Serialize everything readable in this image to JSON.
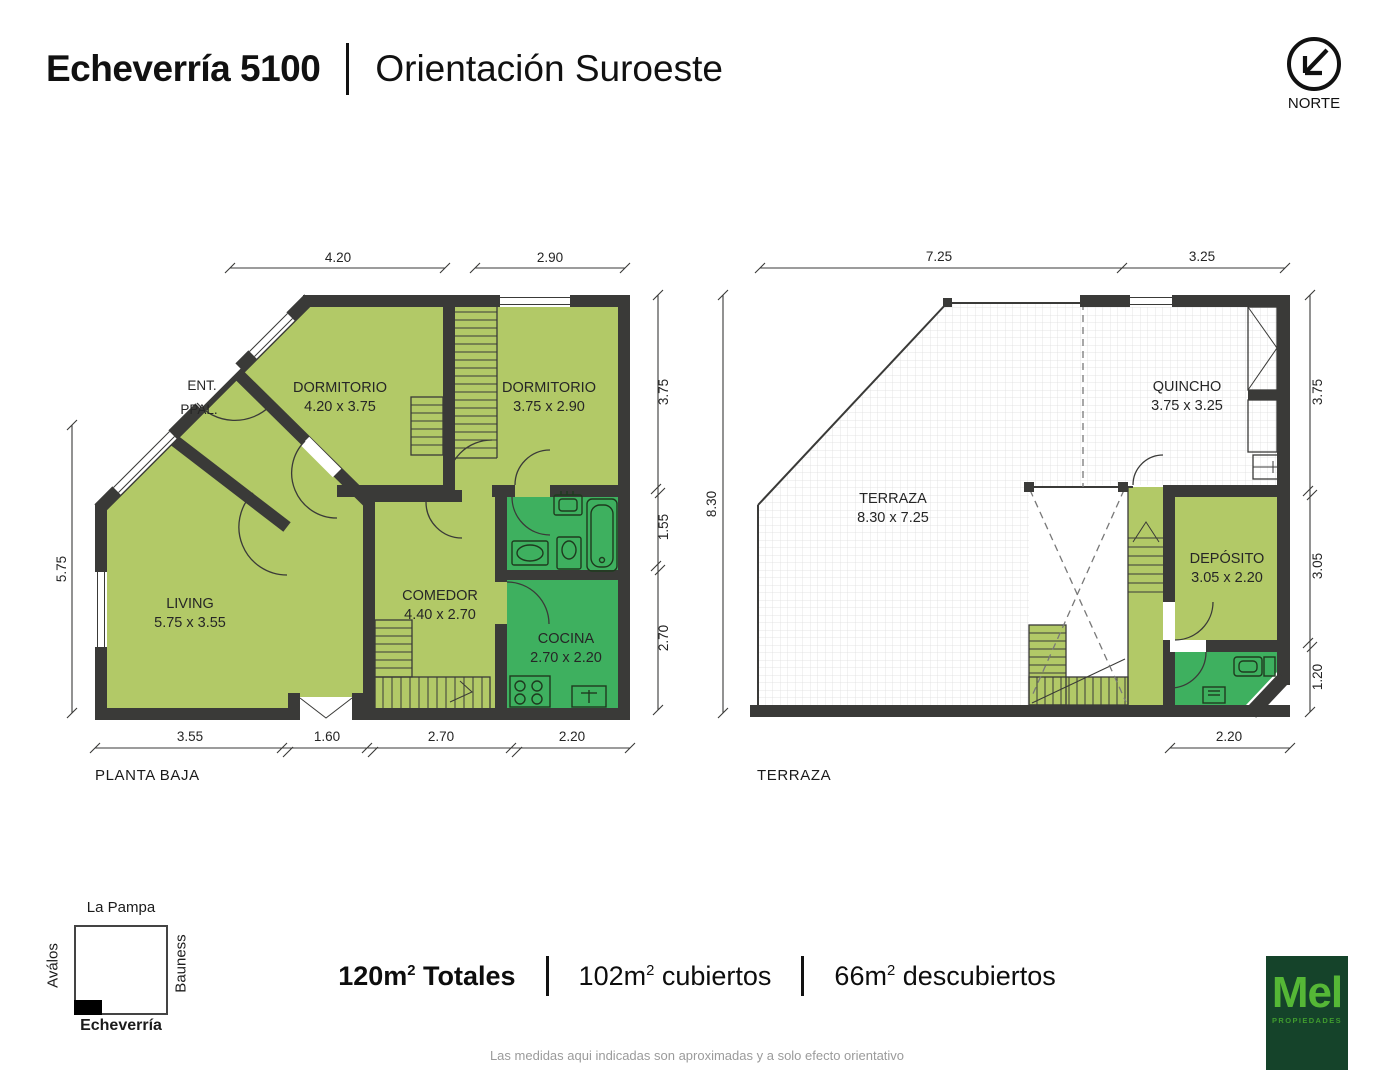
{
  "header": {
    "address": "Echeverría 5100",
    "orientation": "Orientación Suroeste"
  },
  "compass": {
    "label": "NORTE"
  },
  "plans": {
    "planta_baja": {
      "label": "PLANTA BAJA",
      "rooms": {
        "entrada": {
          "line1": "ENT.",
          "line2": "PPAL."
        },
        "dormitorio1": {
          "name": "DORMITORIO",
          "size": "4.20 x 3.75"
        },
        "dormitorio2": {
          "name": "DORMITORIO",
          "size": "3.75 x 2.90"
        },
        "living": {
          "name": "LIVING",
          "size": "5.75 x 3.55"
        },
        "comedor": {
          "name": "COMEDOR",
          "size": "4.40 x 2.70"
        },
        "cocina": {
          "name": "COCINA",
          "size": "2.70 x 2.20"
        }
      },
      "dims": {
        "top": [
          "4.20",
          "2.90"
        ],
        "left": [
          "5.75"
        ],
        "right": [
          "3.75",
          "1.55",
          "2.70"
        ],
        "bottom": [
          "3.55",
          "1.60",
          "2.70",
          "2.20"
        ]
      }
    },
    "terraza": {
      "label": "TERRAZA",
      "rooms": {
        "terraza": {
          "name": "TERRAZA",
          "size": "8.30 x 7.25"
        },
        "quincho": {
          "name": "QUINCHO",
          "size": "3.75 x 3.25"
        },
        "deposito": {
          "name": "DEPÓSITO",
          "size": "3.05 x 2.20"
        }
      },
      "dims": {
        "top": [
          "7.25",
          "3.25"
        ],
        "left": [
          "8.30"
        ],
        "right": [
          "3.75",
          "3.05",
          "1.20"
        ],
        "bottom": [
          "2.20"
        ]
      }
    }
  },
  "map": {
    "top": "La Pampa",
    "left": "Aválos",
    "right": "Bauness",
    "bottom": "Echeverría"
  },
  "summary": {
    "totales": {
      "num": "120m",
      "sup": "2",
      "label": " Totales"
    },
    "cubiertos": {
      "num": "102m",
      "sup": "2",
      "label": " cubiertos"
    },
    "descubiertos": {
      "num": "66m",
      "sup": "2",
      "label": " descubiertos"
    }
  },
  "disclaimer": "Las medidas aqui indicadas son aproximadas y a solo efecto orientativo",
  "logo": {
    "name": "Mel",
    "subtitle": "PROPIEDADES"
  },
  "colors": {
    "room_light": "#b2c967",
    "room_dark": "#3eb05f",
    "wall": "#3a3a38",
    "logo_bg": "#15432a",
    "logo_text": "#55b736",
    "disclaimer_gray": "#9b9b9b"
  }
}
